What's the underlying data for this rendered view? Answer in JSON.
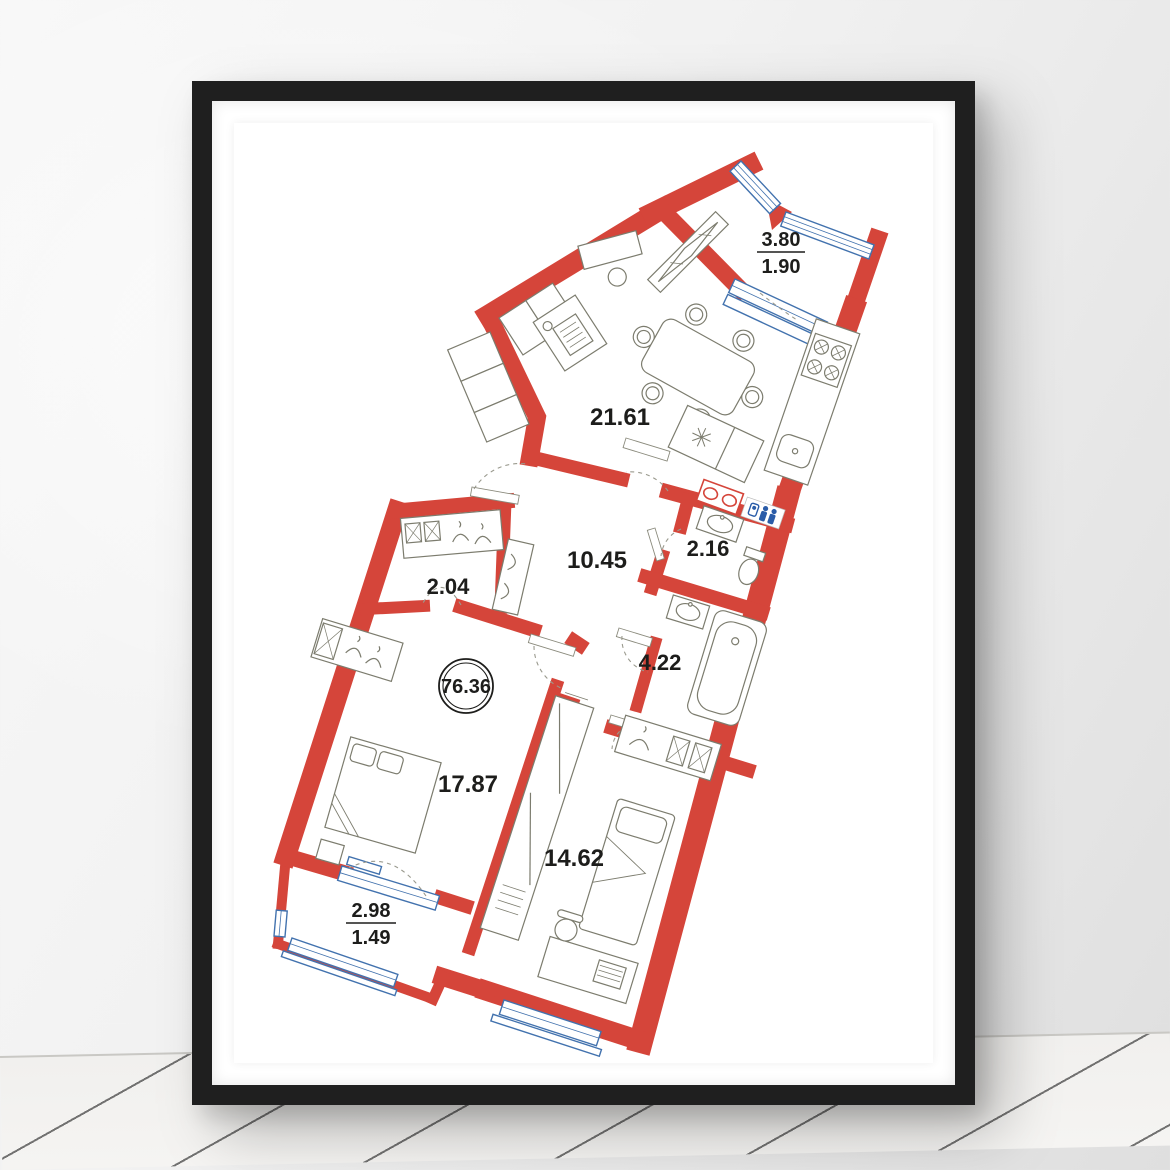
{
  "scene": {
    "description": "framed apartment floor plan poster on wall above white wooden floor"
  },
  "plan": {
    "total_area_label": "76.36",
    "rooms": [
      {
        "id": "living_kitchen",
        "area_label": "21.61"
      },
      {
        "id": "hallway",
        "area_label": "10.45"
      },
      {
        "id": "wc",
        "area_label": "2.16"
      },
      {
        "id": "wardrobe",
        "area_label": "2.04"
      },
      {
        "id": "bathroom",
        "area_label": "4.22"
      },
      {
        "id": "bedroom_main",
        "area_label": "17.87"
      },
      {
        "id": "bedroom_second",
        "area_label": "14.62"
      }
    ],
    "balconies": [
      {
        "id": "balcony_top",
        "area_full": "3.80",
        "area_half": "1.90"
      },
      {
        "id": "balcony_bottom",
        "area_full": "2.98",
        "area_half": "1.49"
      }
    ],
    "colors": {
      "wall_red": "#d5453a",
      "window_blue": "#4272ae",
      "furniture_line": "#7c7c6e",
      "label_text": "#1d1d1b",
      "wc_icon_blue": "#2a5ca8",
      "frame_black": "#1f1f1f"
    },
    "icons": [
      "dining-table",
      "sofa",
      "kitchen-counter",
      "stove-burners",
      "kitchen-sink",
      "double-bed",
      "single-bed",
      "wardrobe-hangers",
      "bathtub",
      "washbasin",
      "toilet",
      "duct-shaft",
      "people-icon",
      "desk",
      "chair"
    ]
  }
}
